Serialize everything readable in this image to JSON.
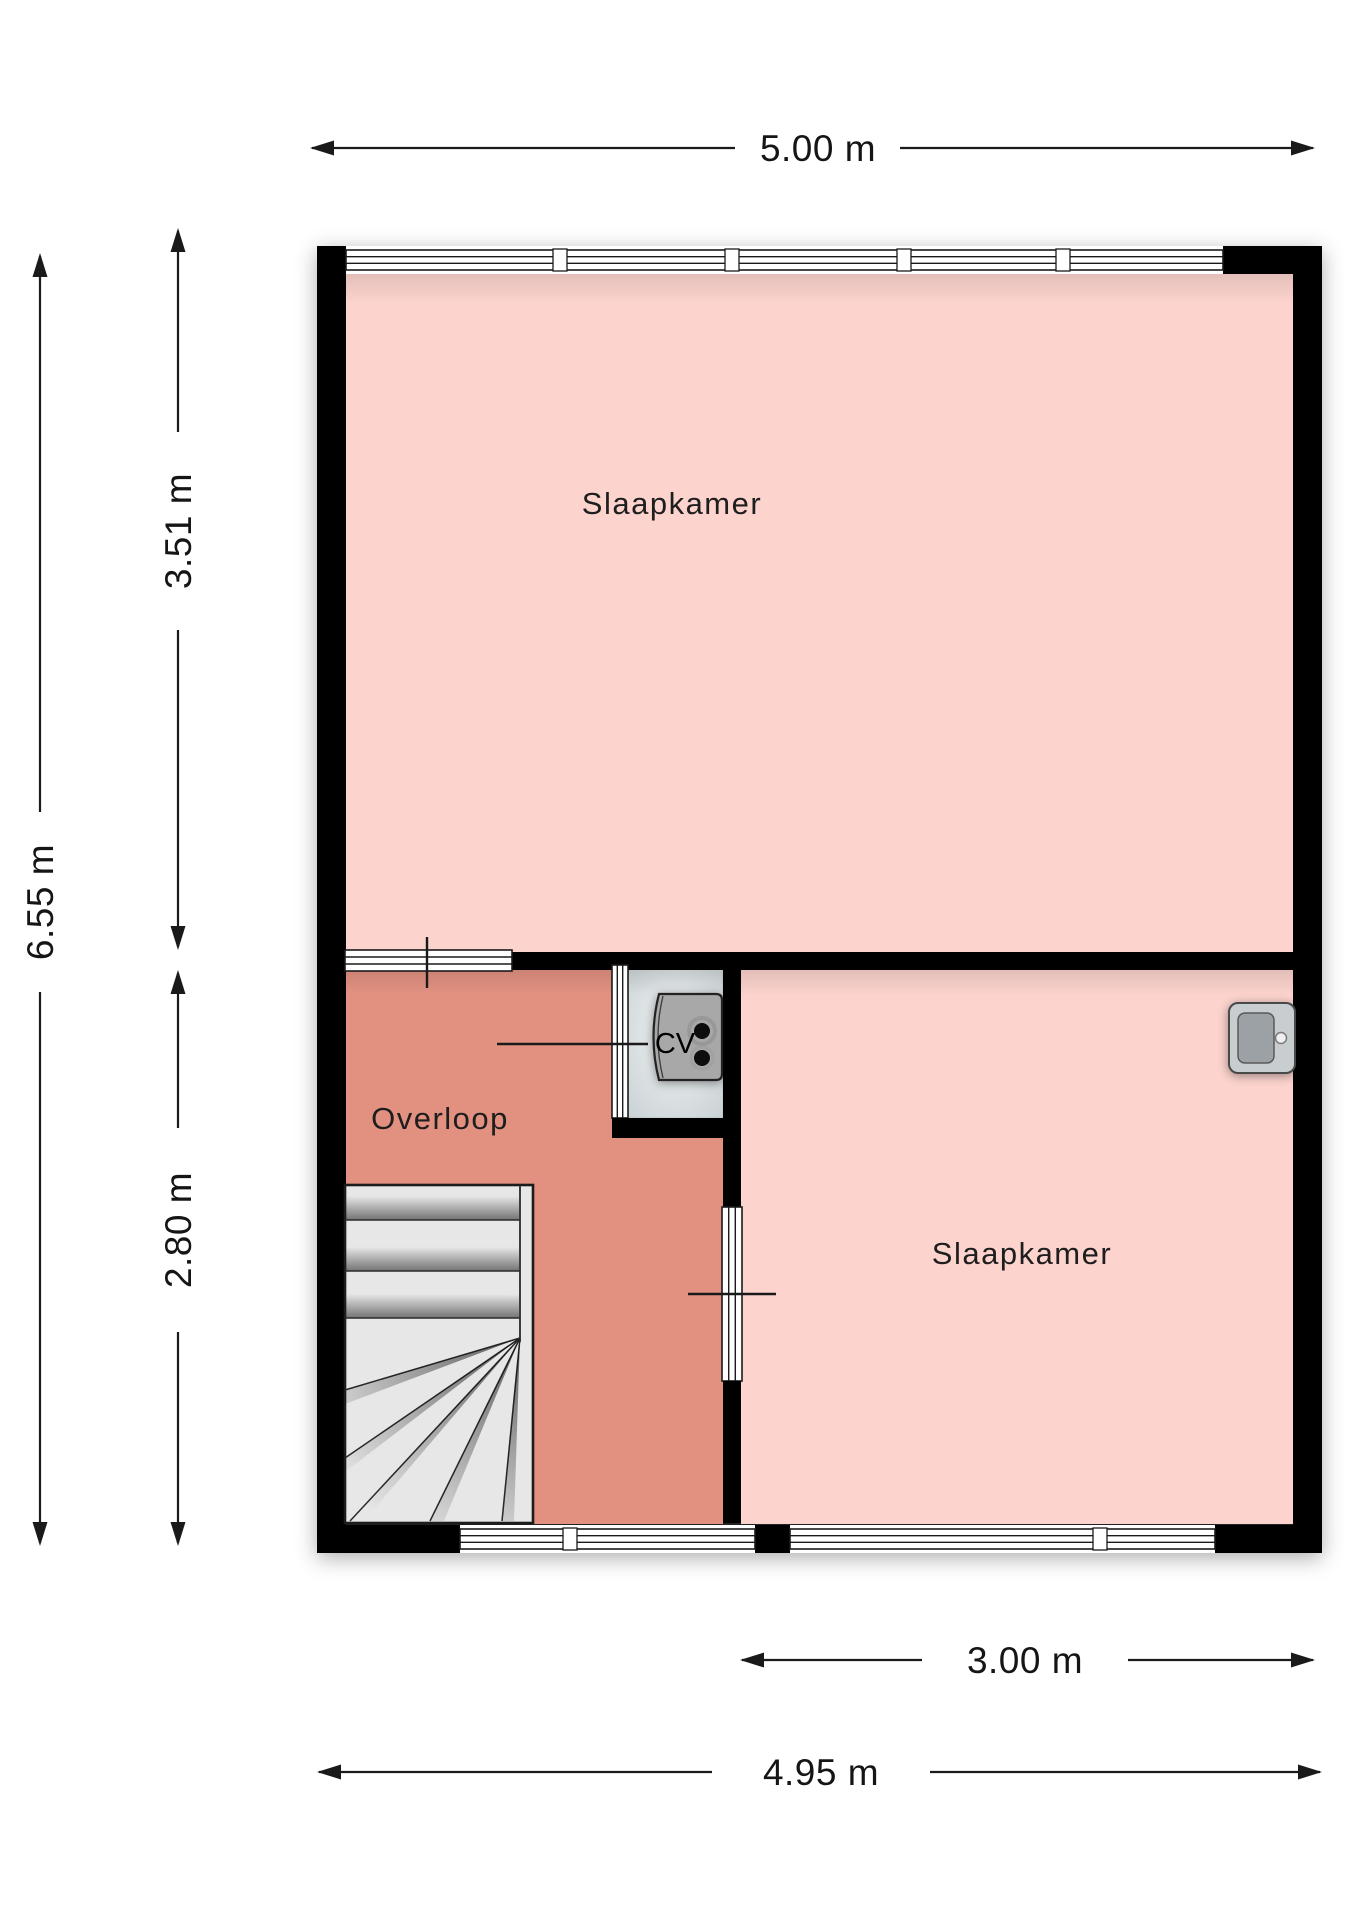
{
  "rooms": {
    "bedroom_top": {
      "label": "Slaapkamer"
    },
    "bedroom_right": {
      "label": "Slaapkamer"
    },
    "landing": {
      "label": "Overloop"
    },
    "cv": {
      "label": "CV"
    }
  },
  "dimensions": {
    "top_width": "5.00 m",
    "total_height": "6.55 m",
    "upper_height": "3.51 m",
    "lower_height": "2.80 m",
    "room_width": "3.00 m",
    "bottom_width": "4.95 m"
  },
  "colors": {
    "wall": "#000000",
    "room_pink": "#fcd3cd",
    "landing_salmon": "#e29181",
    "closet_floor": "#dde3e5",
    "stairs_grey": "#e7e7e7",
    "fixture_grey": "#a8a8a8",
    "sink_body": "#c8cdd0",
    "sink_basin": "#9ba1a4"
  }
}
